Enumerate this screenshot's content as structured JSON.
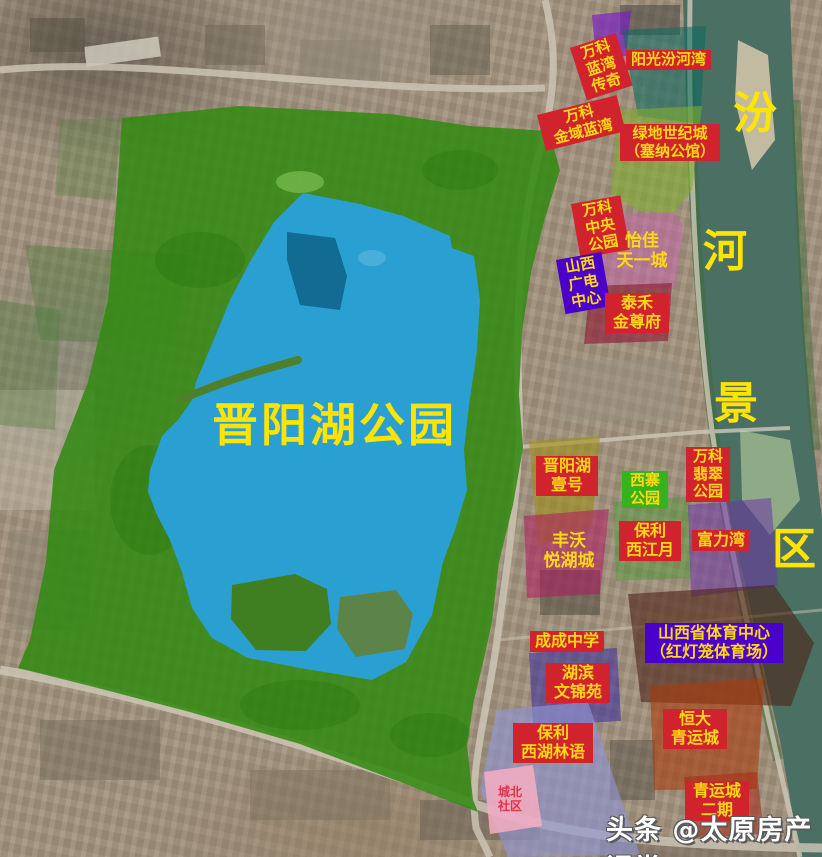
{
  "park": {
    "name": "晋阳湖公园"
  },
  "river": {
    "name": "汾河景区",
    "chars": [
      "汾",
      "河",
      "景",
      "区"
    ]
  },
  "watermark": {
    "text": "头条 @太原房产课堂"
  },
  "labels": [
    {
      "name": "wanke-lanwan-chuanqi",
      "text": "万科\n蓝湾\n传奇",
      "style": "red-box"
    },
    {
      "name": "yangguang-fenhewan",
      "text": "阳光汾河湾",
      "style": "red-box"
    },
    {
      "name": "wanke-jinyu-lanwan",
      "text": "万科\n金域蓝湾",
      "style": "red-box"
    },
    {
      "name": "lvdi-shijicheng",
      "text": "绿地世纪城\n（塞纳公馆）",
      "style": "red-box"
    },
    {
      "name": "wanke-zhongyang-gongyuan",
      "text": "万科\n中央\n公园",
      "style": "red-box"
    },
    {
      "name": "yijia-tianyicheng",
      "text": "怡佳\n天一城",
      "style": "zone-text"
    },
    {
      "name": "shanxi-guangdian-zhongxin",
      "text": "山西\n广电\n中心",
      "style": "purple-box"
    },
    {
      "name": "taihe-jinzunfu",
      "text": "泰禾\n金尊府",
      "style": "red-box"
    },
    {
      "name": "jinyanghu-yihao",
      "text": "晋阳湖\n壹号",
      "style": "red-box"
    },
    {
      "name": "xizhai-gongyuan",
      "text": "西寨\n公园",
      "style": "green-box"
    },
    {
      "name": "wanke-feicui-gongyuan",
      "text": "万科\n翡翠\n公园",
      "style": "red-box"
    },
    {
      "name": "baoli-xijiangyue",
      "text": "保利\n西江月",
      "style": "red-box"
    },
    {
      "name": "fuliwan",
      "text": "富力湾",
      "style": "red-box"
    },
    {
      "name": "fengwo-yuehucheng",
      "text": "丰沃\n悦湖城",
      "style": "zone-text"
    },
    {
      "name": "chengcheng-zhongxue",
      "text": "成成中学",
      "style": "red-box"
    },
    {
      "name": "shanxi-tiyu-zhongxin",
      "text": "山西省体育中心\n（红灯笼体育场）",
      "style": "purple-box"
    },
    {
      "name": "hubin-wenjinyuan",
      "text": "湖滨\n文锦苑",
      "style": "red-box"
    },
    {
      "name": "baoli-xihu-linyu",
      "text": "保利\n西湖林语",
      "style": "red-box"
    },
    {
      "name": "chengbei-shequ",
      "text": "城北\n社区",
      "style": "red-text"
    },
    {
      "name": "hengda-qingyuncheng",
      "text": "恒大\n青运城",
      "style": "red-box"
    },
    {
      "name": "qingyuncheng-erqi",
      "text": "青运城\n二期",
      "style": "red-box"
    }
  ],
  "colors": {
    "label_box_red": "#d0232e",
    "label_box_purple": "#4a00c8",
    "label_box_green": "#35b31c",
    "label_text_yellow": "#ffd814",
    "big_text_yellow": "#ffe400",
    "park_green": "#338a12",
    "lake_blue": "#2aa0d2",
    "lake_dark_patch": "#10688e",
    "river_water": "#4a6f63",
    "zone_teal": "#0a6a5e",
    "zone_lightgreen": "#7fae2f",
    "zone_pink": "#c75fa8",
    "zone_darkred": "#8e1430",
    "zone_olive": "#9f8f18",
    "zone_magenta": "#b0175e",
    "zone_purple": "#6b34a8",
    "zone_stadium_maroon": "#4e2318",
    "zone_orange": "#a83c0e",
    "zone_lavender": "#8f93cf",
    "zone_pink_light": "#f6aec2",
    "watermark_white": "#ffffff"
  }
}
